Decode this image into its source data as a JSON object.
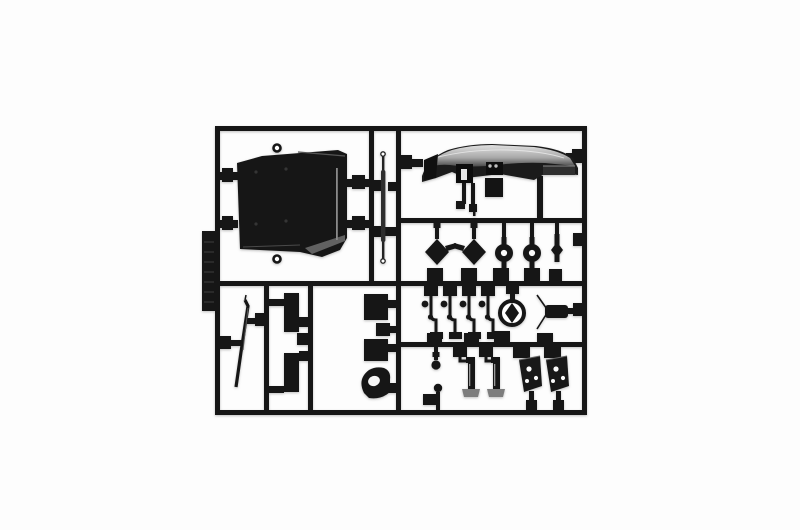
{
  "scene": {
    "description": "Top-down product photo of an injection-molded plastic model kit sprue (parts tree) of black plastic parts on a plain white background",
    "colors": {
      "background": "#fdfdfd",
      "plastic": "#161616",
      "plastic_soft": "#2e2e2e",
      "metal_gray": "#8f8f8f",
      "dash_light": "#e0e0e0",
      "dash_mid": "#a8a8a8",
      "dash_dark": "#3a3a3a",
      "highlight": "#bdbdbd",
      "hole": "#fafafa"
    },
    "frame": {
      "left": 215,
      "top": 126,
      "right": 587,
      "bottom": 415
    },
    "parts": [
      {
        "id": "cab-floor-panel",
        "compartment": "top-left"
      },
      {
        "id": "linkage-rod",
        "compartment": "top-middle-narrow"
      },
      {
        "id": "dashboard",
        "compartment": "top-right"
      },
      {
        "id": "axle-hubs",
        "compartment": "right-row-2",
        "count": 5
      },
      {
        "id": "shift-levers",
        "compartment": "right-row-3",
        "count": 4
      },
      {
        "id": "steering-wheel",
        "compartment": "right-row-3"
      },
      {
        "id": "spindle",
        "compartment": "right-row-3"
      },
      {
        "id": "ball-joints",
        "compartment": "right-row-4",
        "count": 2
      },
      {
        "id": "pedals",
        "compartment": "right-row-4",
        "count": 2
      },
      {
        "id": "bracket-plates",
        "compartment": "right-row-4",
        "count": 2
      },
      {
        "id": "wiper-arm",
        "compartment": "bottom-left"
      },
      {
        "id": "mud-flaps",
        "compartment": "bottom-left-middle",
        "count": 2
      },
      {
        "id": "small-plates",
        "compartment": "bottom-middle",
        "count": 3
      },
      {
        "id": "intake-elbow",
        "compartment": "bottom-middle"
      },
      {
        "id": "sprue-label-tab",
        "compartment": "left-rail"
      }
    ]
  }
}
